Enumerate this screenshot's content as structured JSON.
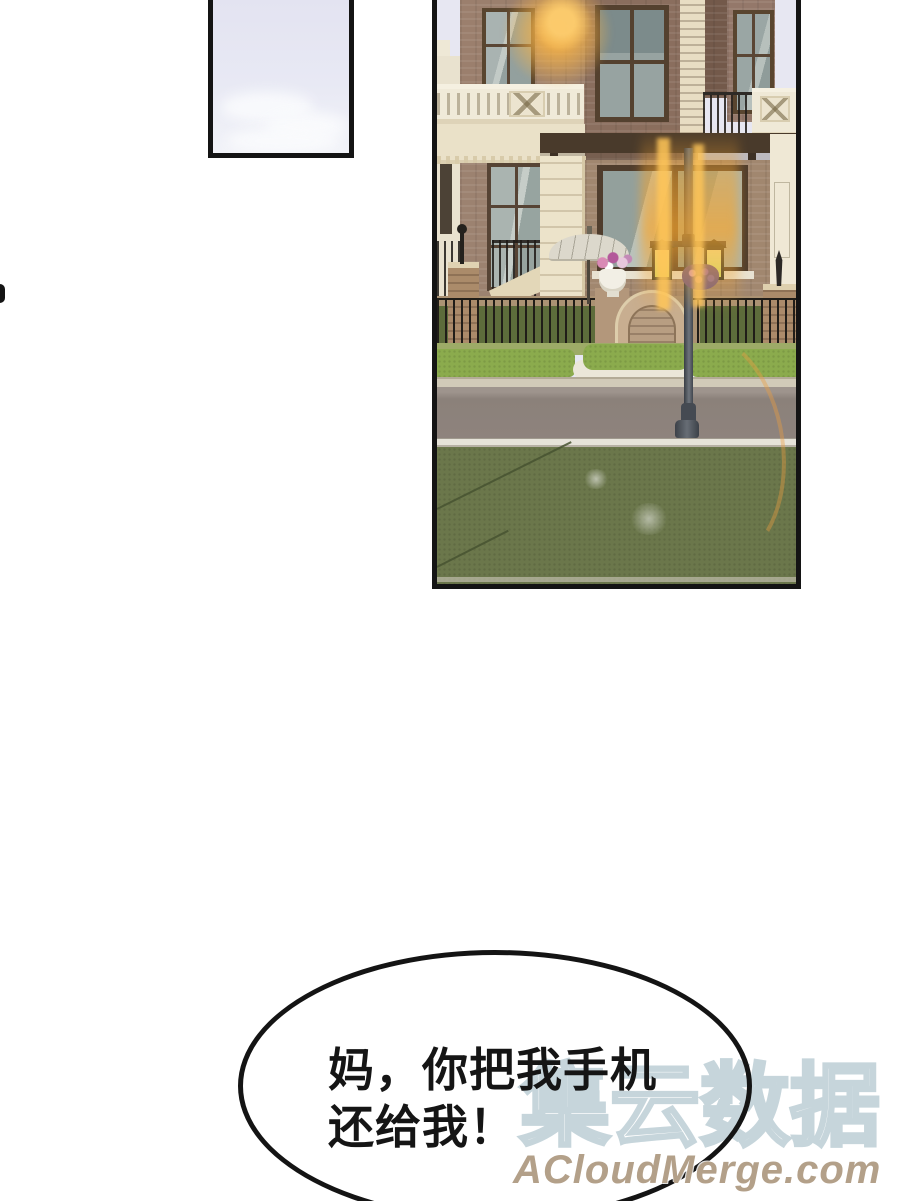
{
  "speech_bubble": {
    "line1": "妈，你把我手机",
    "line2": "还给我！"
  },
  "watermark": {
    "brand": "集云数据",
    "site": "ACloudMerge.com",
    "brand_outline_color": "#c6d5db",
    "site_color": "#b3a089"
  },
  "panels": {
    "sky_panel": {
      "description": "pale lavender sky with soft clouds"
    },
    "villa_panel": {
      "description": "two-story brick villa with balustrades, pergola, patio umbrella, glowing street lamp, iron fence, arched gate, hedge, road and lawn with lens flares"
    }
  },
  "palette": {
    "panel_border": "#141414",
    "sky": "#e7e7f2",
    "brick": "#9b7f6d",
    "cream_stone": "#ece3ca",
    "hedge_green": "#8bab4d",
    "lawn_green": "#6b774b",
    "road": "#8e837d",
    "flare_orange": "#f7a62e",
    "lantern_glow": "#dff07d"
  }
}
